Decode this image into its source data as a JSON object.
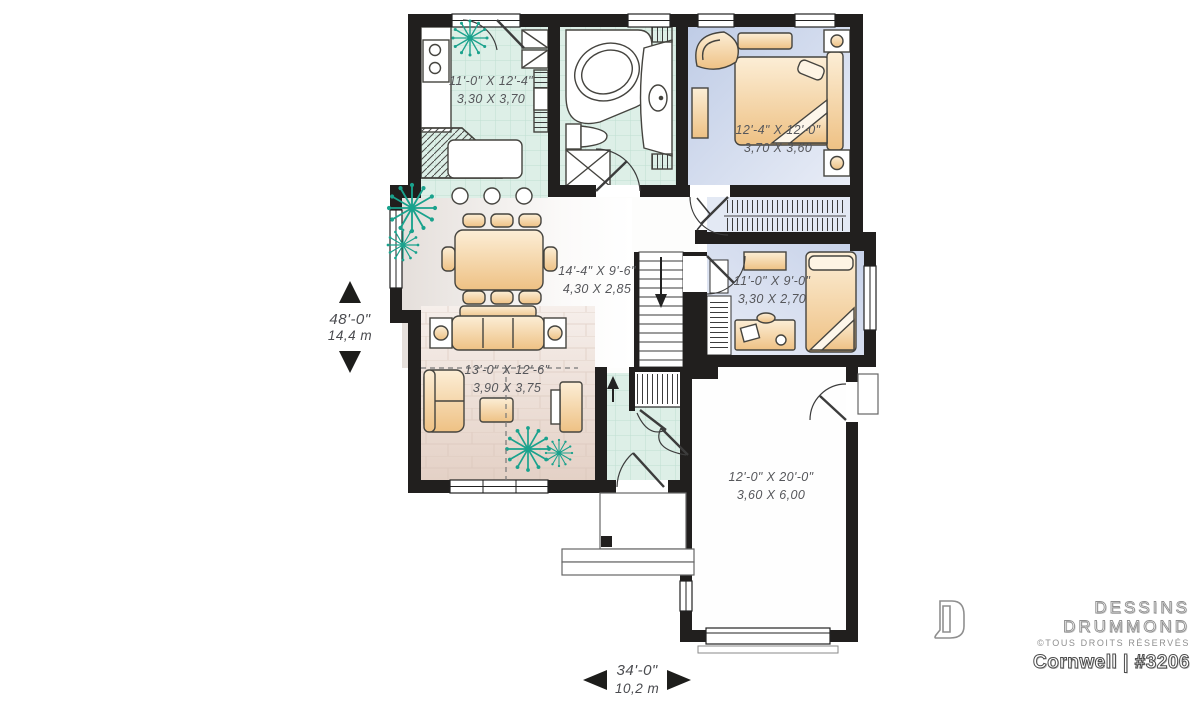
{
  "plan": {
    "rooms": [
      {
        "id": "kitchen",
        "imperial": "11'-0\" X 12'-4\"",
        "metric": "3,30 X 3,70"
      },
      {
        "id": "master-bedroom",
        "imperial": "12'-4\" X 12'-0\"",
        "metric": "3,70 X 3,60"
      },
      {
        "id": "dining-living",
        "imperial": "14'-4\" X 9'-6\"",
        "metric": "4,30 X 2,85"
      },
      {
        "id": "bedroom-2",
        "imperial": "11'-0\" X 9'-0\"",
        "metric": "3,30 X 2,70"
      },
      {
        "id": "living-room",
        "imperial": "13'-0\" X 12'-6\"",
        "metric": "3,90 X 3,75"
      },
      {
        "id": "garage",
        "imperial": "12'-0\" X 20'-0\"",
        "metric": "3,60 X 6,00"
      }
    ],
    "dimensions": {
      "height": {
        "imperial": "48'-0\"",
        "metric": "14,4 m"
      },
      "width": {
        "imperial": "34'-0\"",
        "metric": "10,2 m"
      }
    }
  },
  "branding": {
    "name_line1": "DESSINS",
    "name_line2": "DRUMMOND",
    "rights": "©TOUS DROITS RÉSERVÉS",
    "plan_name": "Cornwell | #3206"
  },
  "colors": {
    "wall": "#211f1e",
    "tile_floor": "#ddefe7",
    "tile_grid": "#bfdfd2",
    "bedroom_floor": "#c3cfe8",
    "wood_floor": "#e7d6cc",
    "furniture": "#f2c98f",
    "plant": "#1aa28d",
    "label_text": "#56575b"
  }
}
